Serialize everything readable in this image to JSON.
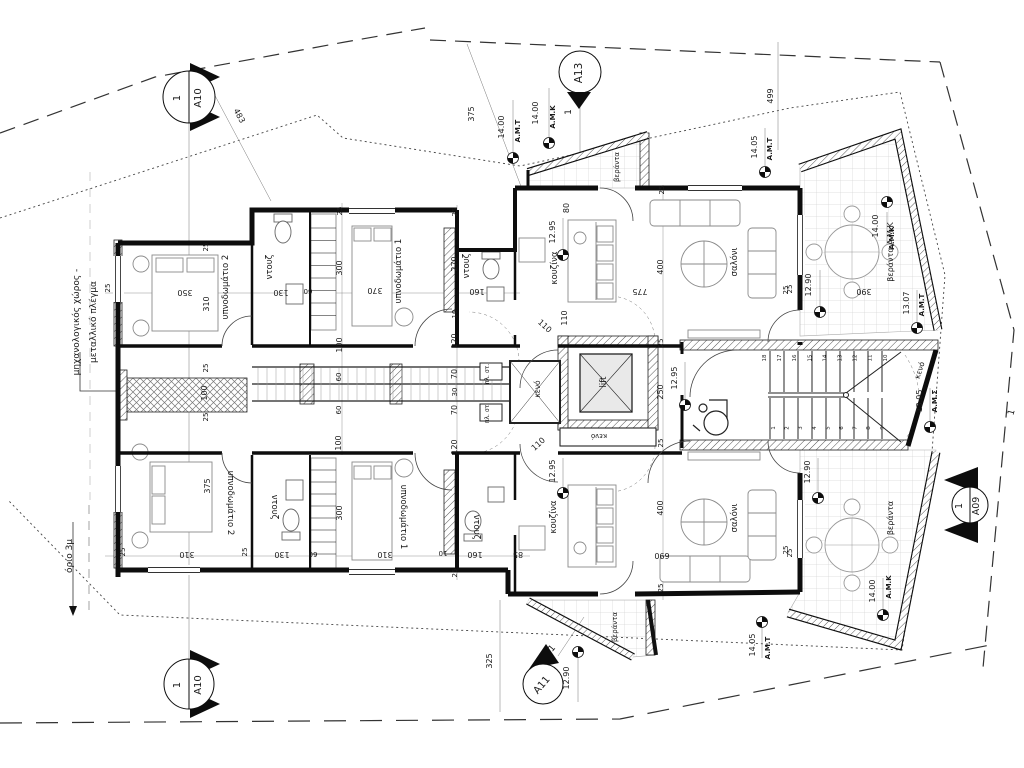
{
  "labels": [
    {
      "t": "483",
      "x": 237,
      "y": 117,
      "r": 62,
      "s": 8
    },
    {
      "t": "375",
      "x": 474,
      "y": 114,
      "r": -90,
      "s": 8
    },
    {
      "t": "499",
      "x": 773,
      "y": 96,
      "r": -90,
      "s": 8
    },
    {
      "t": "1",
      "x": 571,
      "y": 112,
      "r": -90,
      "s": 9
    },
    {
      "t": "1",
      "x": 1014,
      "y": 413,
      "r": -75,
      "s": 9
    },
    {
      "t": "1",
      "x": 554,
      "y": 650,
      "r": -50,
      "s": 9
    },
    {
      "t": "βεράντα",
      "x": 619,
      "y": 167,
      "r": -90,
      "s": 7
    },
    {
      "t": "βεράντα",
      "x": 893,
      "y": 518,
      "r": -90,
      "s": 8
    },
    {
      "t": "βεράντα",
      "x": 617,
      "y": 627,
      "r": -90,
      "s": 7
    },
    {
      "t": "βεράντα  A.M.K",
      "x": 893,
      "y": 252,
      "r": -90,
      "s": 8
    },
    {
      "t": "όριο 3μ",
      "x": 72,
      "y": 556,
      "r": -90,
      "s": 9
    },
    {
      "t": "μηχανολογικός χώρος -",
      "x": 79,
      "y": 322,
      "r": -90,
      "s": 9
    },
    {
      "t": "μεταλλικό πλέγμα",
      "x": 96,
      "y": 322,
      "r": -90,
      "s": 9
    },
    {
      "t": "υπνοδωμάτιο 2",
      "x": 228,
      "y": 287,
      "r": -90,
      "s": 8.5
    },
    {
      "t": "υπνοδωμάτιο 2",
      "x": 228,
      "y": 503,
      "r": 90,
      "s": 8.5
    },
    {
      "t": "υπνοδωμάτιο 1",
      "x": 401,
      "y": 271,
      "r": -90,
      "s": 8.5
    },
    {
      "t": "υπνοδωμάτιο 1",
      "x": 401,
      "y": 517,
      "r": 90,
      "s": 8.5
    },
    {
      "t": "ντουζ",
      "x": 272,
      "y": 267,
      "r": -90,
      "s": 8.5
    },
    {
      "t": "ντουζ",
      "x": 469,
      "y": 266,
      "r": -90,
      "s": 8.5
    },
    {
      "t": "ντουζ",
      "x": 272,
      "y": 507,
      "r": 90,
      "s": 8.5
    },
    {
      "t": "ντουζ",
      "x": 474,
      "y": 527,
      "r": 90,
      "s": 8.5
    },
    {
      "t": "κουζίνα",
      "x": 557,
      "y": 268,
      "r": -90,
      "s": 8.5
    },
    {
      "t": "κουζίνα",
      "x": 556,
      "y": 517,
      "r": -90,
      "s": 8.5
    },
    {
      "t": "σαλόνι",
      "x": 737,
      "y": 262,
      "r": -90,
      "s": 8.5
    },
    {
      "t": "σαλόνι",
      "x": 737,
      "y": 518,
      "r": -90,
      "s": 8.5
    },
    {
      "t": "κενό",
      "x": 540,
      "y": 389,
      "r": -90,
      "s": 7.5
    },
    {
      "t": "κενό",
      "x": 599,
      "y": 434,
      "r": 180,
      "s": 7
    },
    {
      "t": "κενό",
      "x": 922,
      "y": 371,
      "r": -72,
      "s": 7.5
    },
    {
      "t": "lift",
      "x": 606,
      "y": 382,
      "r": -90,
      "s": 8.5
    },
    {
      "t": "πλ. στ.",
      "x": 489,
      "y": 374,
      "r": -90,
      "s": 6
    },
    {
      "t": "πλ. στ.",
      "x": 489,
      "y": 413,
      "r": -90,
      "s": 6
    },
    {
      "t": "350",
      "x": 185,
      "y": 290,
      "r": 180,
      "s": 8
    },
    {
      "t": "310",
      "x": 209,
      "y": 304,
      "r": -90,
      "s": 8
    },
    {
      "t": "130",
      "x": 281,
      "y": 290,
      "r": 180,
      "s": 8
    },
    {
      "t": "60",
      "x": 308,
      "y": 289,
      "r": 180,
      "s": 7
    },
    {
      "t": "300",
      "x": 342,
      "y": 268,
      "r": -90,
      "s": 8
    },
    {
      "t": "370",
      "x": 375,
      "y": 288,
      "r": 180,
      "s": 8
    },
    {
      "t": "160",
      "x": 477,
      "y": 289,
      "r": 180,
      "s": 8
    },
    {
      "t": "270",
      "x": 457,
      "y": 264,
      "r": -90,
      "s": 8
    },
    {
      "t": "25",
      "x": 110,
      "y": 288,
      "r": -90,
      "s": 7
    },
    {
      "t": "25",
      "x": 208,
      "y": 247,
      "r": -90,
      "s": 7
    },
    {
      "t": "25",
      "x": 342,
      "y": 211,
      "r": -90,
      "s": 7
    },
    {
      "t": "25",
      "x": 457,
      "y": 212,
      "r": -90,
      "s": 7
    },
    {
      "t": "100",
      "x": 342,
      "y": 345,
      "r": -90,
      "s": 8
    },
    {
      "t": "60",
      "x": 341,
      "y": 377,
      "r": -90,
      "s": 7
    },
    {
      "t": "60",
      "x": 341,
      "y": 410,
      "r": -90,
      "s": 7
    },
    {
      "t": "100",
      "x": 207,
      "y": 393,
      "r": -90,
      "s": 8
    },
    {
      "t": "25",
      "x": 208,
      "y": 368,
      "r": -90,
      "s": 7
    },
    {
      "t": "25",
      "x": 208,
      "y": 417,
      "r": -90,
      "s": 7
    },
    {
      "t": "10",
      "x": 457,
      "y": 314,
      "r": -90,
      "s": 7
    },
    {
      "t": "120",
      "x": 457,
      "y": 341,
      "r": -90,
      "s": 8
    },
    {
      "t": "70",
      "x": 457,
      "y": 374,
      "r": -90,
      "s": 8
    },
    {
      "t": "30",
      "x": 457,
      "y": 392,
      "r": -90,
      "s": 7
    },
    {
      "t": "70",
      "x": 457,
      "y": 410,
      "r": -90,
      "s": 8
    },
    {
      "t": "120",
      "x": 457,
      "y": 447,
      "r": -90,
      "s": 8
    },
    {
      "t": "80",
      "x": 569,
      "y": 208,
      "r": -90,
      "s": 8
    },
    {
      "t": "110",
      "x": 567,
      "y": 318,
      "r": -90,
      "s": 8
    },
    {
      "t": "110",
      "x": 543,
      "y": 328,
      "r": 42,
      "s": 8
    },
    {
      "t": "110",
      "x": 540,
      "y": 446,
      "r": -42,
      "s": 8
    },
    {
      "t": "775",
      "x": 640,
      "y": 289,
      "r": 180,
      "s": 8
    },
    {
      "t": "400",
      "x": 663,
      "y": 267,
      "r": -90,
      "s": 8
    },
    {
      "t": "400",
      "x": 663,
      "y": 508,
      "r": -90,
      "s": 8
    },
    {
      "t": "690",
      "x": 662,
      "y": 553,
      "r": 180,
      "s": 8
    },
    {
      "t": "25",
      "x": 664,
      "y": 190,
      "r": -90,
      "s": 7
    },
    {
      "t": "25",
      "x": 788,
      "y": 290,
      "r": -90,
      "s": 7
    },
    {
      "t": "25",
      "x": 792,
      "y": 289,
      "r": -90,
      "s": 7
    },
    {
      "t": "390",
      "x": 864,
      "y": 289,
      "r": 180,
      "s": 8
    },
    {
      "t": "25",
      "x": 663,
      "y": 343,
      "r": -90,
      "s": 7
    },
    {
      "t": "250",
      "x": 663,
      "y": 392,
      "r": -90,
      "s": 8
    },
    {
      "t": "25",
      "x": 663,
      "y": 443,
      "r": -90,
      "s": 7
    },
    {
      "t": "375",
      "x": 210,
      "y": 486,
      "r": -90,
      "s": 8
    },
    {
      "t": "310",
      "x": 187,
      "y": 552,
      "r": 180,
      "s": 8
    },
    {
      "t": "25",
      "x": 125,
      "y": 552,
      "r": -90,
      "s": 7
    },
    {
      "t": "25",
      "x": 247,
      "y": 552,
      "r": -90,
      "s": 7
    },
    {
      "t": "130",
      "x": 282,
      "y": 552,
      "r": 180,
      "s": 8
    },
    {
      "t": "60",
      "x": 313,
      "y": 552,
      "r": 180,
      "s": 7
    },
    {
      "t": "300",
      "x": 342,
      "y": 513,
      "r": -90,
      "s": 8
    },
    {
      "t": "100",
      "x": 341,
      "y": 443,
      "r": -90,
      "s": 8
    },
    {
      "t": "310",
      "x": 385,
      "y": 552,
      "r": 180,
      "s": 8
    },
    {
      "t": "10",
      "x": 443,
      "y": 551,
      "r": 180,
      "s": 7
    },
    {
      "t": "160",
      "x": 475,
      "y": 552,
      "r": 180,
      "s": 8
    },
    {
      "t": "85",
      "x": 518,
      "y": 552,
      "r": 180,
      "s": 8
    },
    {
      "t": "25",
      "x": 457,
      "y": 573,
      "r": -90,
      "s": 7
    },
    {
      "t": "25",
      "x": 663,
      "y": 588,
      "r": -90,
      "s": 7
    },
    {
      "t": "25",
      "x": 788,
      "y": 550,
      "r": -90,
      "s": 7
    },
    {
      "t": "25",
      "x": 792,
      "y": 553,
      "r": -90,
      "s": 7
    },
    {
      "t": "325",
      "x": 492,
      "y": 661,
      "r": -90,
      "s": 8
    }
  ],
  "level_markers": [
    {
      "v": "14.00",
      "sfx": "A.M.T",
      "x": 513,
      "y": 158,
      "vx": 504,
      "vy": 127,
      "sx": 520,
      "sy": 131
    },
    {
      "v": "14.00",
      "sfx": "A.M.K",
      "x": 549,
      "y": 143,
      "vx": 538,
      "vy": 113,
      "sx": 555,
      "sy": 117
    },
    {
      "v": "14.05",
      "sfx": "A.M.T",
      "x": 765,
      "y": 172,
      "vx": 757,
      "vy": 147,
      "sx": 772,
      "sy": 149
    },
    {
      "v": "14.00",
      "sfx": "A.M.K",
      "x": 887,
      "y": 202,
      "vx": 878,
      "vy": 226,
      "sx": 894,
      "sy": 238
    },
    {
      "v": "12.90",
      "sfx": "",
      "x": 820,
      "y": 312,
      "vx": 811,
      "vy": 285,
      "sx": 0,
      "sy": 0
    },
    {
      "v": "13.07",
      "sfx": "A.M.T",
      "x": 917,
      "y": 328,
      "vx": 909,
      "vy": 303,
      "sx": 924,
      "sy": 305
    },
    {
      "v": "13.05",
      "sfx": "A.M.Σ",
      "x": 930,
      "y": 427,
      "vx": 922,
      "vy": 401,
      "sx": 937,
      "sy": 401
    },
    {
      "v": "12.95",
      "sfx": "",
      "x": 685,
      "y": 405,
      "vx": 677,
      "vy": 378,
      "sx": 0,
      "sy": 0
    },
    {
      "v": "12.95",
      "sfx": "",
      "x": 563,
      "y": 255,
      "vx": 555,
      "vy": 232,
      "sx": 0,
      "sy": 0
    },
    {
      "v": "12.95",
      "sfx": "",
      "x": 563,
      "y": 493,
      "vx": 555,
      "vy": 471,
      "sx": 0,
      "sy": 0
    },
    {
      "v": "12.90",
      "sfx": "",
      "x": 818,
      "y": 498,
      "vx": 810,
      "vy": 472,
      "sx": 0,
      "sy": 0
    },
    {
      "v": "14.00",
      "sfx": "A.M.K",
      "x": 883,
      "y": 615,
      "vx": 875,
      "vy": 591,
      "sx": 891,
      "sy": 587
    },
    {
      "v": "14.05",
      "sfx": "A.M.T",
      "x": 762,
      "y": 622,
      "vx": 755,
      "vy": 645,
      "sx": 770,
      "sy": 648
    },
    {
      "v": "12.90",
      "sfx": "",
      "x": 578,
      "y": 652,
      "vx": 569,
      "vy": 678,
      "sx": 0,
      "sy": 0
    }
  ],
  "section_markers": [
    {
      "style": "a10",
      "num": "1",
      "sheet": "A10",
      "x": 189,
      "y": 97,
      "cr": 26,
      "tr": -90
    },
    {
      "style": "a13",
      "num": "",
      "sheet": "A13",
      "x": 580,
      "y": 72,
      "cr": 21,
      "tr": -90
    },
    {
      "style": "a09",
      "num": "1",
      "sheet": "A09",
      "x": 970,
      "y": 505,
      "cr": 18,
      "tr": -90
    },
    {
      "style": "a11",
      "num": "",
      "sheet": "A11",
      "x": 543,
      "y": 684,
      "cr": 20,
      "tr": -50
    },
    {
      "style": "a10",
      "num": "1",
      "sheet": "A10",
      "x": 189,
      "y": 684,
      "cr": 25,
      "tr": -90
    }
  ],
  "stairs": {
    "bottom": [
      "1",
      "2",
      "3",
      "4",
      "5",
      "6",
      "7",
      "8",
      "9"
    ],
    "top": [
      "18",
      "17",
      "16",
      "15",
      "14",
      "13",
      "12",
      "11",
      "10"
    ]
  }
}
